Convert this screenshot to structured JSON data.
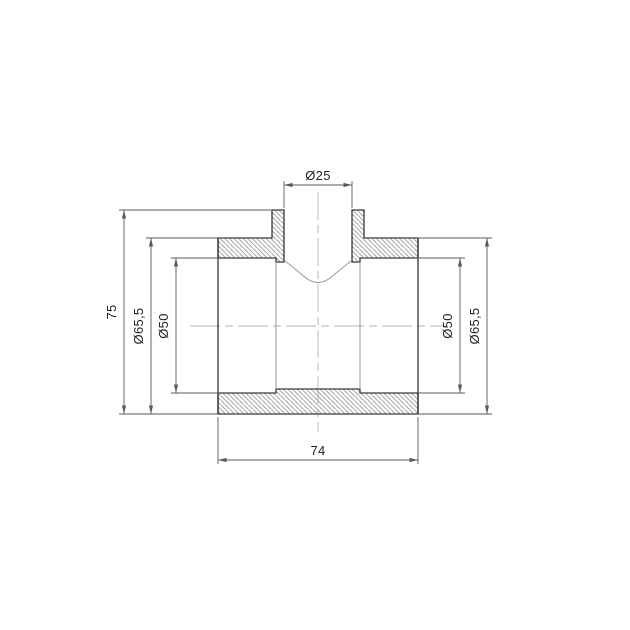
{
  "drawing": {
    "type": "technical-cross-section",
    "subject": "pipe-tee-fitting",
    "dimensions": {
      "branch_inner_diameter": "Ø25",
      "overall_height": "75",
      "outer_diameter_left": "Ø65,5",
      "inner_diameter_left": "Ø50",
      "inner_diameter_right": "Ø50",
      "outer_diameter_right": "Ø65,5",
      "overall_length": "74"
    },
    "colors": {
      "background": "#ffffff",
      "outline": "#3a3a3a",
      "soft_edge": "#9a9a9a",
      "dimension": "#5a5a5a",
      "hatch": "#8f8f8f",
      "centerline": "#b3b3b3",
      "text": "#1f1f1f"
    }
  }
}
